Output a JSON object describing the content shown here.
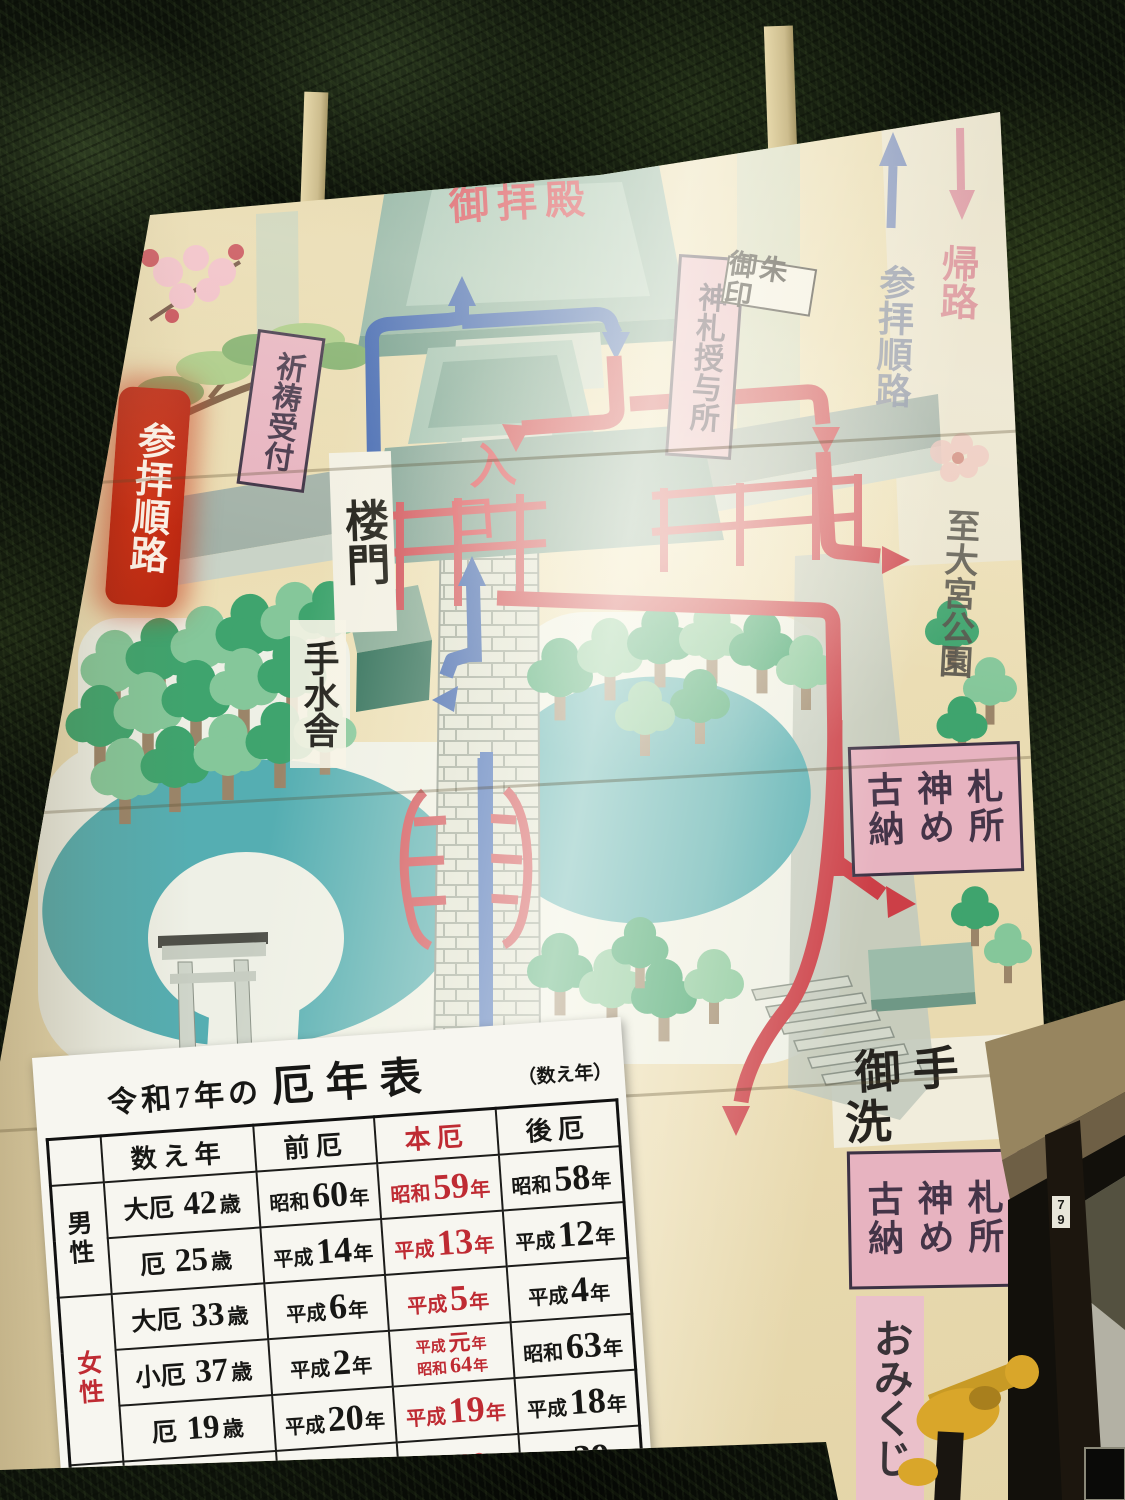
{
  "sign": {
    "labels": {
      "main_hall": "御拝殿",
      "route_banner": "参拝順路",
      "prayer_reception": "祈祷受付",
      "amulet_office": "神札授与所",
      "goshuin": "御朱印",
      "tower_gate": "楼門",
      "entrance": "入口",
      "temizusha": "手水舎",
      "worship_route": "参拝順路",
      "return_route": "帰路",
      "to_park": "至大宮公園",
      "old_amulet_line1": "古神札",
      "old_amulet_line2": "納め所",
      "otearai": "御手洗",
      "omikuji": "おみくじ"
    },
    "colors": {
      "banner_red": "#c6261d",
      "label_pink": "#e7b3c0",
      "route_red": "#cc3f47",
      "route_blue": "#3c63b0",
      "pond_teal": "#55aeb2",
      "board_cream": "#e8d9ae"
    }
  },
  "scene": {
    "pillar_tag": "79"
  },
  "table": {
    "title_prefix": "令和7年の",
    "title_main": "厄年表",
    "title_note": "（数え年）",
    "headers": [
      "数え年",
      "前厄",
      "本厄",
      "後厄"
    ],
    "age_suffix": "歳",
    "year_suffix": "年",
    "groups": [
      {
        "label": "男性",
        "red": false,
        "rows": [
          {
            "kind": "大厄",
            "age": "42",
            "mae": {
              "era": "昭和",
              "num": "60"
            },
            "hon": {
              "era": "昭和",
              "num": "59"
            },
            "ato": {
              "era": "昭和",
              "num": "58"
            }
          },
          {
            "kind": "厄",
            "age": "25",
            "mae": {
              "era": "平成",
              "num": "14"
            },
            "hon": {
              "era": "平成",
              "num": "13"
            },
            "ato": {
              "era": "平成",
              "num": "12"
            }
          }
        ]
      },
      {
        "label": "女性",
        "red": true,
        "rows": [
          {
            "kind": "大厄",
            "age": "33",
            "mae": {
              "era": "平成",
              "num": "6"
            },
            "hon": {
              "era": "平成",
              "num": "5"
            },
            "ato": {
              "era": "平成",
              "num": "4"
            }
          },
          {
            "kind": "小厄",
            "age": "37",
            "mae": {
              "era": "平成",
              "num": "2"
            },
            "hon": {
              "lines": [
                {
                  "era": "平成",
                  "num": "元"
                },
                {
                  "era": "昭和",
                  "num": "64"
                }
              ]
            },
            "ato": {
              "era": "昭和",
              "num": "63"
            }
          },
          {
            "kind": "厄",
            "age": "19",
            "mae": {
              "era": "平成",
              "num": "20"
            },
            "hon": {
              "era": "平成",
              "num": "19"
            },
            "ato": {
              "era": "平成",
              "num": "18"
            }
          }
        ]
      },
      {
        "label": "男女",
        "label_parts": [
          {
            "t": "男",
            "red": false
          },
          {
            "t": "女",
            "red": true
          }
        ],
        "rows": [
          {
            "kind": "厄",
            "age": "61",
            "mae": {
              "era": "昭和",
              "num": "41"
            },
            "hon": {
              "era": "昭和",
              "num": "40"
            },
            "ato": {
              "era": "昭和",
              "num": "39"
            }
          }
        ]
      }
    ]
  }
}
